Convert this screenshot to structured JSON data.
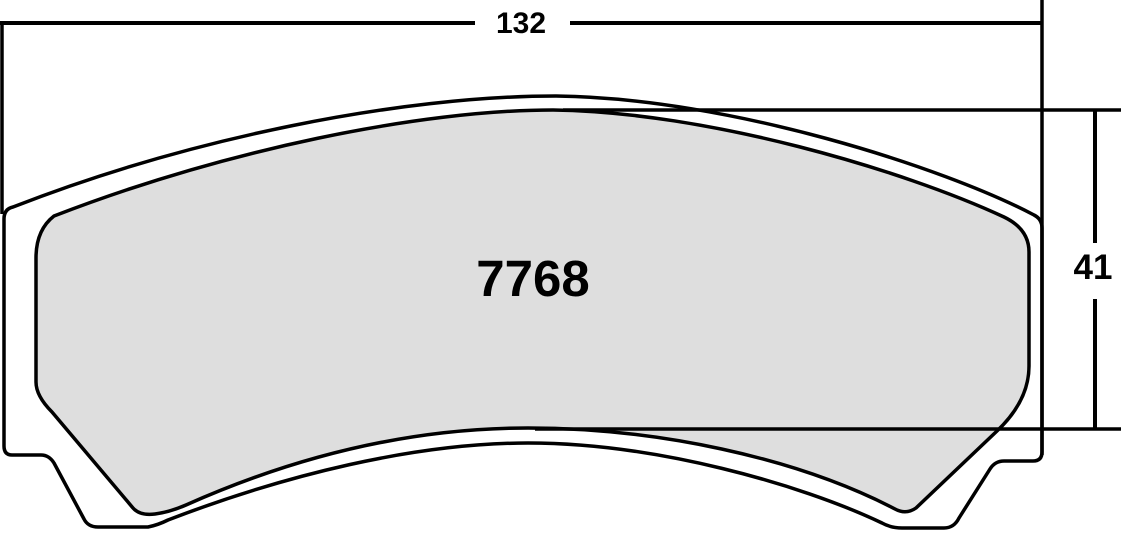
{
  "diagram": {
    "title": "brake pad dimension drawing",
    "part_number": "7768",
    "dimensions": {
      "width_label": "132",
      "height_label": "41"
    },
    "colors": {
      "line": "#000000",
      "friction_fill": "#dedede",
      "background": "#ffffff"
    }
  }
}
